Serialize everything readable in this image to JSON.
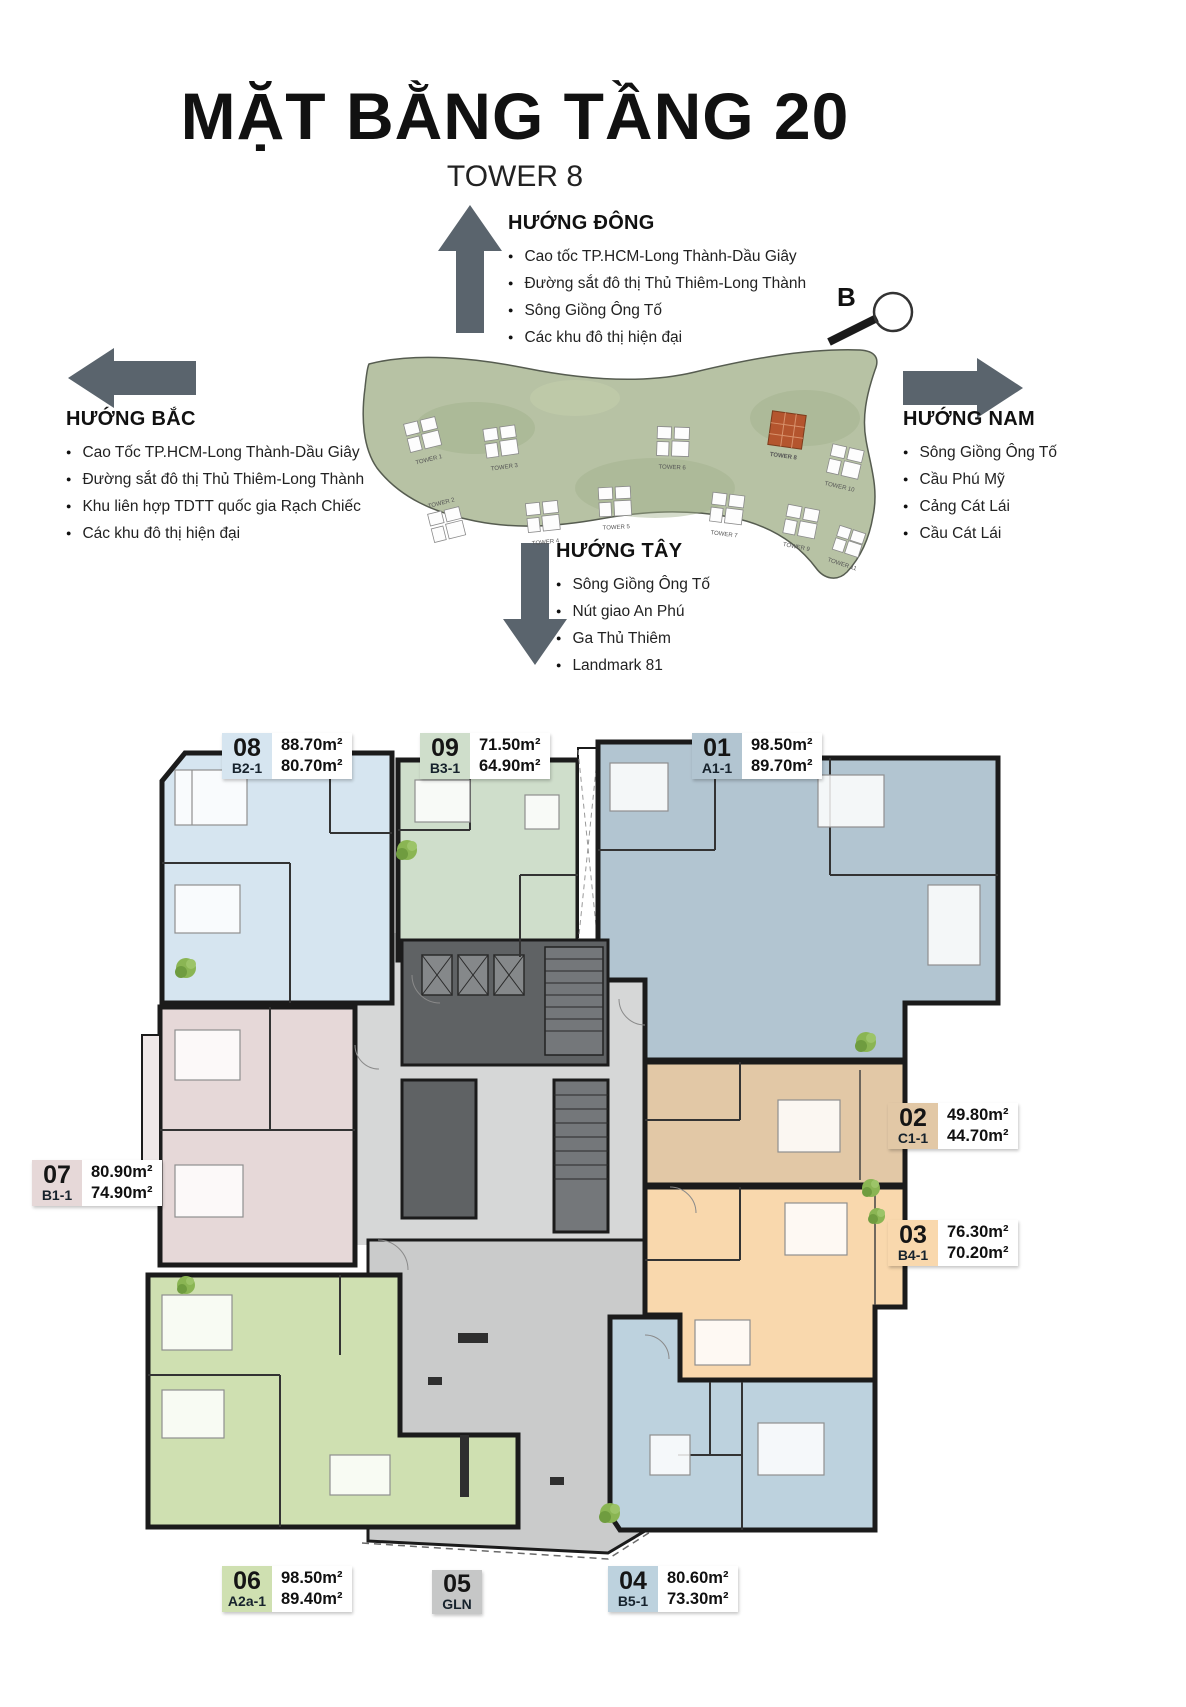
{
  "page": {
    "title": "MẶT BẰNG TẦNG 20",
    "subtitle": "TOWER 8"
  },
  "directions": {
    "east": {
      "label": "HƯỚNG ĐÔNG",
      "items": [
        "Cao tốc TP.HCM-Long Thành-Dầu Giây",
        "Đường sắt đô thị Thủ Thiêm-Long Thành",
        "Sông Giồng Ông Tố",
        "Các khu đô thị hiện đại"
      ]
    },
    "north": {
      "label": "HƯỚNG BẮC",
      "items": [
        "Cao Tốc TP.HCM-Long Thành-Dầu Giây",
        "Đường sắt đô thị Thủ Thiêm-Long Thành",
        "Khu liên hợp TDTT quốc gia Rạch Chiếc",
        "Các khu đô thị hiện đại"
      ]
    },
    "south": {
      "label": "HƯỚNG NAM",
      "items": [
        "Sông Giồng Ông Tố",
        "Cầu Phú Mỹ",
        "Cảng Cát Lái",
        "Cầu Cát Lái"
      ]
    },
    "west": {
      "label": "HƯỚNG TÂY",
      "items": [
        "Sông Giồng Ông Tố",
        "Nút giao An Phú",
        "Ga Thủ Thiêm",
        "Landmark 81"
      ]
    }
  },
  "compass": {
    "label": "B"
  },
  "site_map": {
    "highlight_color": "#b4552e",
    "towers": [
      {
        "name": "TOWER 1"
      },
      {
        "name": "TOWER 2"
      },
      {
        "name": "TOWER 3"
      },
      {
        "name": "TOWER 4"
      },
      {
        "name": "TOWER 5"
      },
      {
        "name": "TOWER 6"
      },
      {
        "name": "TOWER 7"
      },
      {
        "name": "TOWER 8",
        "highlighted": true
      },
      {
        "name": "TOWER 9"
      },
      {
        "name": "TOWER 10"
      },
      {
        "name": "TOWER 11"
      }
    ]
  },
  "units": {
    "u01": {
      "number": "01",
      "code": "A1-1",
      "area_gross": "98.50m²",
      "area_net": "89.70m²",
      "color": "#b2c5d1"
    },
    "u02": {
      "number": "02",
      "code": "C1-1",
      "area_gross": "49.80m²",
      "area_net": "44.70m²",
      "color": "#e2c8a6"
    },
    "u03": {
      "number": "03",
      "code": "B4-1",
      "area_gross": "76.30m²",
      "area_net": "70.20m²",
      "color": "#f9d8ad"
    },
    "u04": {
      "number": "04",
      "code": "B5-1",
      "area_gross": "80.60m²",
      "area_net": "73.30m²",
      "color": "#bdd2de"
    },
    "u05": {
      "number": "05",
      "code": "GLN",
      "color": "#c6c7c7"
    },
    "u06": {
      "number": "06",
      "code": "A2a-1",
      "area_gross": "98.50m²",
      "area_net": "89.40m²",
      "color": "#cfe0b1"
    },
    "u07": {
      "number": "07",
      "code": "B1-1",
      "area_gross": "80.90m²",
      "area_net": "74.90m²",
      "color": "#e6d8d8"
    },
    "u08": {
      "number": "08",
      "code": "B2-1",
      "area_gross": "88.70m²",
      "area_net": "80.70m²",
      "color": "#d6e5f0"
    },
    "u09": {
      "number": "09",
      "code": "B3-1",
      "area_gross": "71.50m²",
      "area_net": "64.90m²",
      "color": "#cfdecb"
    }
  }
}
